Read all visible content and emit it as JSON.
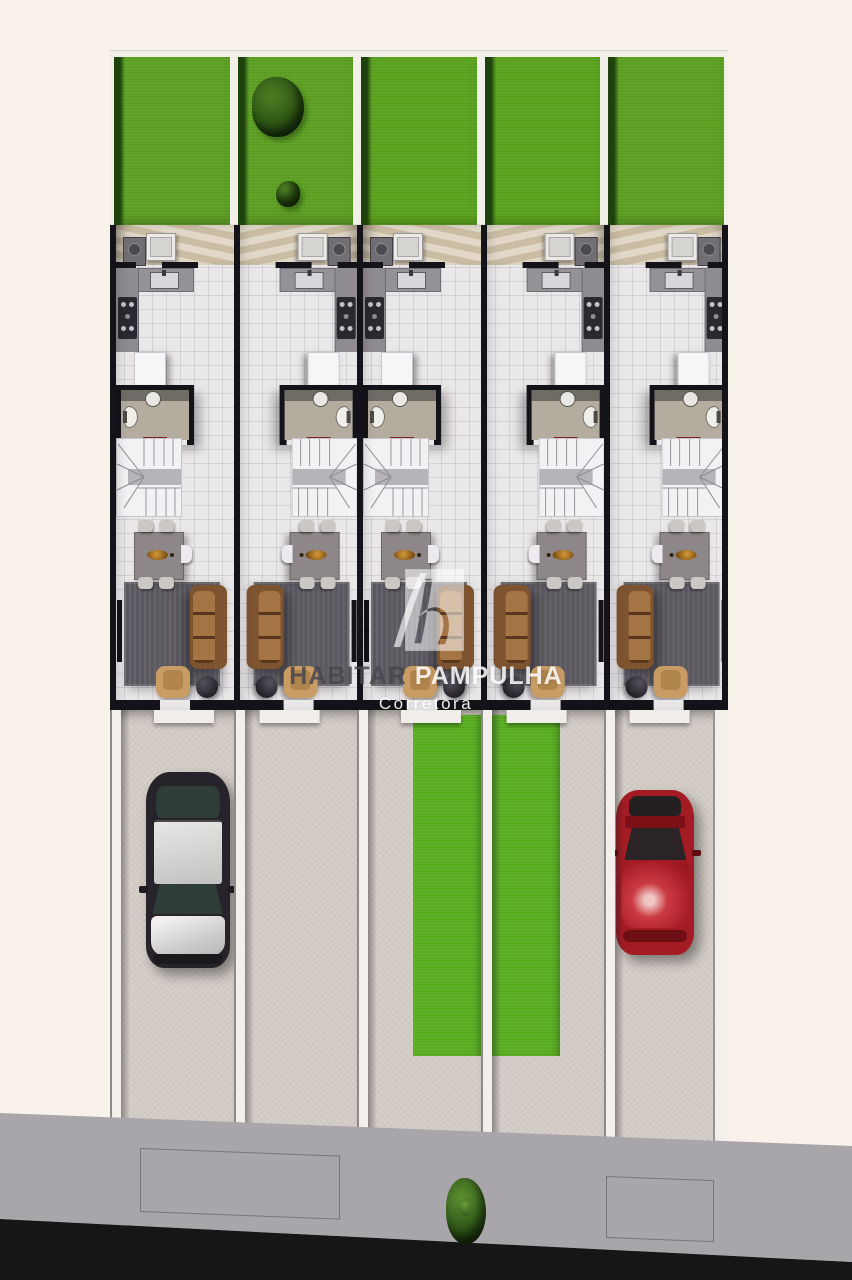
{
  "watermark": {
    "logo": "habitar-h-monogram",
    "brand_primary": "HABITAR",
    "brand_secondary": "PAMPULHA",
    "tagline": "Corretora"
  },
  "scene": {
    "description": "Top-down 3D architectural rendering of five attached townhouse units: green backyards at the rear, ground-floor plans (service patio, kitchen, bathroom, winder staircase, dining and living rooms), private driveways in front, sidewalk and asphalt street at the bottom",
    "units_count": 5,
    "units": [
      {
        "id": 1,
        "mirrored": false,
        "yard_trees": false,
        "driveway": "car-dark"
      },
      {
        "id": 2,
        "mirrored": true,
        "yard_trees": true,
        "driveway": "empty"
      },
      {
        "id": 3,
        "mirrored": false,
        "yard_trees": false,
        "driveway": "grass-right"
      },
      {
        "id": 4,
        "mirrored": true,
        "yard_trees": false,
        "driveway": "grass-left"
      },
      {
        "id": 5,
        "mirrored": true,
        "yard_trees": false,
        "driveway": "car-red"
      }
    ],
    "rooms_per_unit": [
      "service-patio",
      "kitchen",
      "bathroom",
      "staircase",
      "dining-room",
      "living-room"
    ],
    "parked_cars": [
      {
        "unit": 1,
        "color": "dark-with-silver-roof"
      },
      {
        "unit": 5,
        "color": "red"
      }
    ]
  },
  "palette": {
    "bg": "#f8f2ea",
    "band_white": "#f2efe9",
    "grass": "#5ca41f",
    "grass2": "#58ad1f",
    "grass_dark": "#1d420c",
    "patio": "#d5c9b1",
    "floor": "#eae7e9",
    "wall": "#15131a",
    "concrete": "#d3ccc6",
    "divider": "#f3f0eb",
    "sidewalk": "#a8a6ab",
    "street": "#161616",
    "sofa": "#7d5330",
    "cushion": "#a57444",
    "rug": "#5b5860",
    "chair_tan": "#c89c64",
    "wood": "#8e8789",
    "glass": "#2f3d38",
    "car_dark_body": "#26242a",
    "car_red_body": "#a31b23",
    "wm_dark": "rgba(73,71,77,0.85)",
    "wm_light": "rgba(255,255,255,0.85)"
  }
}
